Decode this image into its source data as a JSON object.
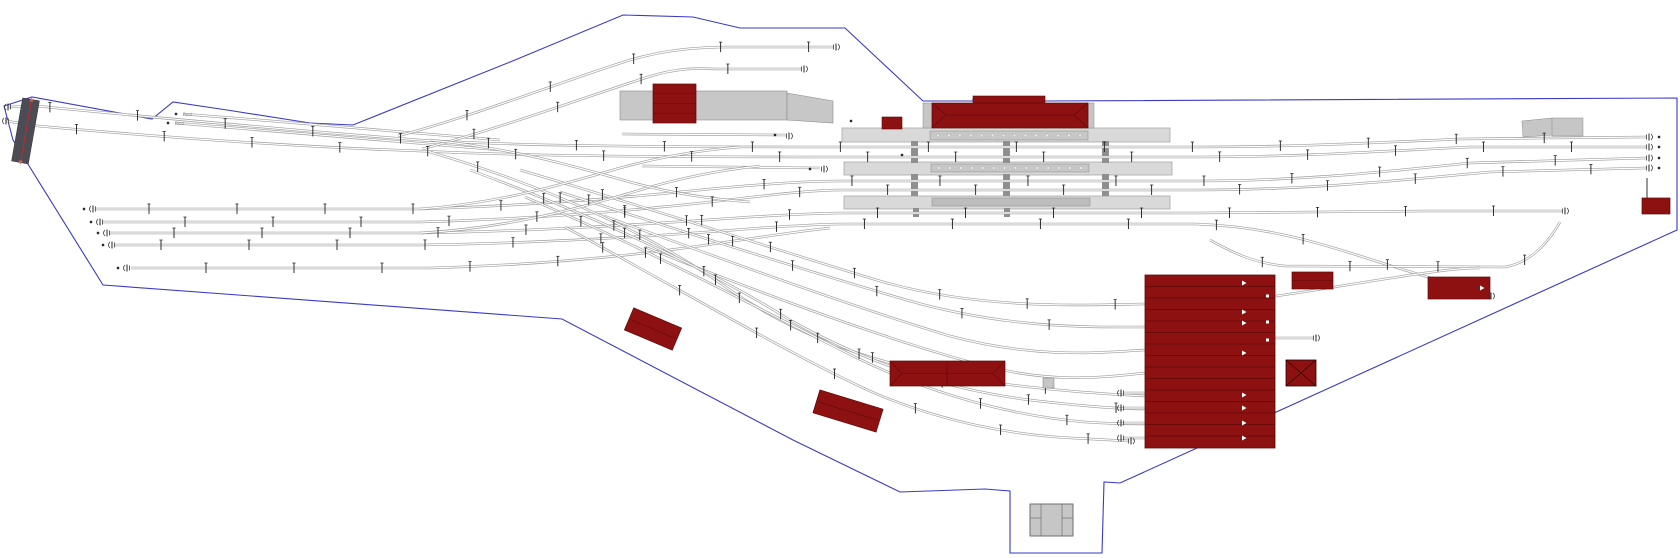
{
  "canvas": {
    "w": 1680,
    "h": 558,
    "bg": "#ffffff"
  },
  "palette": {
    "boundary": "#3a3ac8",
    "rail": "#9d9d9d",
    "rail_core": "#ffffff",
    "mast": "#1c1c1c",
    "red": "#8e1111",
    "red_dark": "#5c0a0a",
    "platform": "#d9d9d9",
    "platform_border": "#a8a8a8",
    "canopy": "#c7c7c7",
    "canopy_dot": "#f4f4f4",
    "inner_strip": "#bdbdbd",
    "connector": "#8f8f8f",
    "bridge": "#4c4c55",
    "bridge_line": "#b03030",
    "gray_bldg": "#c6c6c6",
    "gray_border": "#8a8a8a",
    "buffer": "#3a3a3a",
    "dot": "#2a2a2a"
  },
  "boundary": {
    "points": [
      [
        4,
        106
      ],
      [
        32,
        97
      ],
      [
        152,
        119
      ],
      [
        173,
        102
      ],
      [
        227,
        110
      ],
      [
        310,
        123
      ],
      [
        353,
        125
      ],
      [
        515,
        60
      ],
      [
        623,
        15
      ],
      [
        693,
        17
      ],
      [
        740,
        28
      ],
      [
        845,
        28
      ],
      [
        923,
        101
      ],
      [
        973,
        101
      ],
      [
        973,
        99
      ],
      [
        1043,
        99
      ],
      [
        1043,
        101
      ],
      [
        1677,
        98
      ],
      [
        1677,
        230
      ],
      [
        1120,
        483
      ],
      [
        1104,
        482
      ],
      [
        1102,
        553
      ],
      [
        1010,
        553
      ],
      [
        1010,
        491
      ],
      [
        985,
        489
      ],
      [
        900,
        492
      ],
      [
        793,
        440
      ],
      [
        562,
        319
      ],
      [
        103,
        285
      ],
      [
        13,
        140
      ]
    ]
  },
  "tracks": [
    {
      "name": "main-line-1",
      "masts": true,
      "d": "M 8 107 L 36 106 C 160 118 300 131 420 140 C 520 146 650 147 840 147 L 1195 147 C 1300 147 1390 142 1460 139 L 1646 137"
    },
    {
      "name": "main-line-2",
      "masts": true,
      "d": "M 6 121 L 38 126 C 160 137 300 147 420 151 C 530 156 650 157 840 157 L 1195 157 C 1310 157 1400 150 1470 147 L 1646 147"
    },
    {
      "name": "siding-rest-a",
      "masts": false,
      "d": "M 183 114 C 290 122 400 132 500 140"
    },
    {
      "name": "siding-rest-b",
      "masts": false,
      "d": "M 175 123 C 290 132 400 142 500 150"
    },
    {
      "name": "yard-track-1",
      "masts": true,
      "d": "M 96 209 L 420 209 C 520 206 610 199 690 191 C 750 185 800 181 840 181 L 1195 181 C 1310 181 1400 170 1470 163 L 1646 158"
    },
    {
      "name": "yard-track-2",
      "masts": true,
      "d": "M 103 222 L 420 222 C 530 219 630 211 710 202 C 770 195 810 190 845 190 L 1195 190 C 1320 190 1420 178 1490 172 L 1646 168"
    },
    {
      "name": "yard-track-3",
      "masts": true,
      "d": "M 110 233 L 420 233 C 540 231 650 224 750 217 C 800 214 825 213 845 213 L 1195 213 C 1280 213 1360 212 1430 211 L 1562 211"
    },
    {
      "name": "yard-track-4",
      "masts": true,
      "d": "M 115 245 L 420 245 C 550 243 660 236 760 228 C 805 225 825 224 845 224 L 1195 224 C 1260 226 1310 240 1360 256 C 1410 272 1450 284 1488 295"
    },
    {
      "name": "yard-track-5",
      "masts": true,
      "d": "M 131 268 L 430 268 C 540 265 640 255 720 243 C 770 236 800 231 830 228"
    },
    {
      "name": "right-loop",
      "masts": true,
      "d": "M 1210 240 C 1235 254 1255 263 1285 266 L 1505 267 C 1530 263 1548 243 1560 222"
    },
    {
      "name": "right-cross",
      "masts": false,
      "d": "M 1232 302 C 1300 294 1370 280 1440 271 C 1455 269 1468 268 1480 268"
    },
    {
      "name": "depot-feed-1",
      "masts": true,
      "d": "M 520 170 C 650 208 770 248 880 281 C 980 310 1080 305 1145 304"
    },
    {
      "name": "depot-feed-2",
      "masts": true,
      "d": "M 560 192 C 690 234 810 272 910 301 C 1010 329 1090 327 1145 327"
    },
    {
      "name": "depot-feed-3",
      "masts": false,
      "d": "M 604 216 C 730 262 850 306 950 336 C 1040 360 1105 352 1145 350"
    },
    {
      "name": "depot-feed-4",
      "masts": false,
      "d": "M 645 247 C 770 297 890 341 985 366 C 1060 385 1112 376 1145 373"
    },
    {
      "name": "south-curve-1",
      "masts": true,
      "d": "M 430 152 C 560 190 660 240 730 290 C 800 338 880 365 960 378 C 1040 390 1100 394 1145 396"
    },
    {
      "name": "south-curve-2",
      "masts": true,
      "d": "M 470 170 C 600 218 710 270 790 320 C 870 365 950 390 1030 400 C 1090 407 1125 409 1145 409"
    },
    {
      "name": "south-curve-3",
      "masts": true,
      "d": "M 525 197 C 655 252 765 312 855 357 C 935 396 1015 416 1085 422 C 1115 424 1135 424 1145 424"
    },
    {
      "name": "south-curve-4",
      "masts": true,
      "d": "M 565 227 C 685 292 785 352 872 392 C 942 422 1012 435 1072 438 L 1128 441"
    },
    {
      "name": "north-branch-1",
      "masts": true,
      "d": "M 398 136 C 480 114 560 82 630 60 C 668 49 700 47 732 47 L 833 47"
    },
    {
      "name": "north-branch-2",
      "masts": true,
      "d": "M 422 149 C 505 127 585 97 648 77 C 682 66 702 69 724 69 L 801 69"
    },
    {
      "name": "mid-stub-1",
      "masts": false,
      "d": "M 622 134 L 786 135"
    },
    {
      "name": "mid-stub-2",
      "masts": false,
      "d": "M 642 166 L 820 168"
    },
    {
      "name": "ladder-diag-1",
      "masts": false,
      "d": "M 420 209 C 500 203 560 185 620 168 C 660 157 700 150 740 147"
    },
    {
      "name": "ladder-diag-2",
      "masts": false,
      "d": "M 420 233 C 510 228 580 208 640 190 C 680 178 720 170 760 166"
    },
    {
      "name": "ladder-diag-3",
      "masts": false,
      "d": "M 430 140 C 510 148 570 165 630 182 C 670 193 710 199 750 202"
    },
    {
      "name": "depot-stub-a",
      "masts": false,
      "d": "M 1124 393 L 1145 393"
    },
    {
      "name": "depot-stub-b",
      "masts": false,
      "d": "M 1124 408 L 1145 408"
    },
    {
      "name": "depot-stub-c",
      "masts": false,
      "d": "M 1124 423 L 1145 423"
    },
    {
      "name": "depot-stub-d",
      "masts": false,
      "d": "M 1124 438 L 1145 438"
    },
    {
      "name": "depot-right-stub",
      "masts": false,
      "d": "M 1275 338 L 1313 338"
    }
  ],
  "mast_cfg": {
    "spacing": 88,
    "start": 42,
    "len": 10
  },
  "buffers": [
    {
      "x": 93,
      "y": 209,
      "dir": -1
    },
    {
      "x": 100,
      "y": 222,
      "dir": -1
    },
    {
      "x": 107,
      "y": 233,
      "dir": -1
    },
    {
      "x": 112,
      "y": 245,
      "dir": -1
    },
    {
      "x": 127,
      "y": 268,
      "dir": -1
    },
    {
      "x": 8,
      "y": 107,
      "dir": -1
    },
    {
      "x": 6,
      "y": 121,
      "dir": -1
    },
    {
      "x": 1121,
      "y": 393,
      "dir": -1
    },
    {
      "x": 1121,
      "y": 408,
      "dir": -1
    },
    {
      "x": 1121,
      "y": 423,
      "dir": -1
    },
    {
      "x": 1121,
      "y": 438,
      "dir": -1
    },
    {
      "x": 836,
      "y": 47,
      "dir": 1
    },
    {
      "x": 804,
      "y": 69,
      "dir": 1
    },
    {
      "x": 789,
      "y": 136,
      "dir": 1
    },
    {
      "x": 824,
      "y": 169,
      "dir": 1
    },
    {
      "x": 1649,
      "y": 137,
      "dir": 1
    },
    {
      "x": 1649,
      "y": 147,
      "dir": 1
    },
    {
      "x": 1649,
      "y": 158,
      "dir": 1
    },
    {
      "x": 1649,
      "y": 168,
      "dir": 1
    },
    {
      "x": 1565,
      "y": 211,
      "dir": 1
    },
    {
      "x": 1491,
      "y": 296,
      "dir": 1
    },
    {
      "x": 1316,
      "y": 338,
      "dir": 1
    },
    {
      "x": 1131,
      "y": 441,
      "dir": 1
    }
  ],
  "dots": [
    [
      84,
      209
    ],
    [
      91,
      222
    ],
    [
      98,
      233
    ],
    [
      103,
      245
    ],
    [
      118,
      268
    ],
    [
      1659,
      137
    ],
    [
      1659,
      147
    ],
    [
      1659,
      158
    ],
    [
      1659,
      168
    ],
    [
      176,
      114
    ],
    [
      168,
      123
    ],
    [
      775,
      135
    ],
    [
      810,
      169
    ],
    [
      851,
      121
    ],
    [
      902,
      155
    ]
  ],
  "platforms": [
    {
      "name": "platform-1",
      "x": 842,
      "y": 128,
      "w": 328,
      "h": 14
    },
    {
      "name": "platform-2",
      "x": 844,
      "y": 162,
      "w": 328,
      "h": 13
    },
    {
      "name": "platform-3",
      "x": 844,
      "y": 196,
      "w": 326,
      "h": 13
    }
  ],
  "canopies": [
    {
      "name": "canopy-1",
      "x": 930,
      "y": 131,
      "w": 158,
      "h": 9,
      "dots": 14
    },
    {
      "name": "canopy-2",
      "x": 931,
      "y": 164,
      "w": 158,
      "h": 8,
      "dots": 14
    },
    {
      "name": "canopy-3",
      "x": 932,
      "y": 198,
      "w": 158,
      "h": 8,
      "dots": 0
    }
  ],
  "connectors": [
    [
      911,
      141,
      7,
      22
    ],
    [
      911,
      174,
      7,
      22
    ],
    [
      913,
      208,
      6,
      9
    ],
    [
      1003,
      115,
      7,
      13
    ],
    [
      1003,
      141,
      7,
      22
    ],
    [
      1003,
      174,
      7,
      22
    ],
    [
      1004,
      208,
      6,
      9
    ],
    [
      1102,
      141,
      7,
      22
    ],
    [
      1102,
      174,
      7,
      22
    ]
  ],
  "loading_dock": {
    "rect": {
      "x": 620,
      "y": 91,
      "w": 167,
      "h": 29
    },
    "wedge": [
      [
        787,
        93
      ],
      [
        833,
        101
      ],
      [
        833,
        123
      ],
      [
        787,
        120
      ]
    ]
  },
  "station": {
    "building": {
      "x": 932,
      "y": 103,
      "w": 156,
      "h": 25
    },
    "center_raised": {
      "x": 973,
      "y": 96,
      "w": 72,
      "h": 7
    },
    "cap_left": {
      "x": 923,
      "y": 103,
      "w": 9,
      "h": 25
    },
    "cap_right": {
      "x": 1088,
      "y": 103,
      "w": 6,
      "h": 25
    },
    "annex": {
      "x": 882,
      "y": 117,
      "w": 20,
      "h": 12
    }
  },
  "goods_shed": {
    "x": 653,
    "y": 84,
    "w": 43,
    "h": 39,
    "lines": 3
  },
  "depot": {
    "x": 1145,
    "y": 275,
    "w": 130,
    "h": 173,
    "stall_step": 11.5,
    "arrow_x": 1242,
    "arrows_y": [
      283,
      312,
      323,
      353,
      395,
      408,
      423,
      438
    ],
    "square_x": 1266,
    "squares_y": [
      296,
      322,
      340
    ]
  },
  "red_shed_1": {
    "x": 1292,
    "y": 272,
    "w": 41,
    "h": 17
  },
  "red_shed_2": {
    "x": 1428,
    "y": 277,
    "w": 62,
    "h": 22,
    "arrow": [
      1480,
      288
    ]
  },
  "x_square": {
    "x": 1286,
    "y": 360,
    "w": 30,
    "h": 26
  },
  "far_right_shed": {
    "x": 1642,
    "y": 198,
    "w": 28,
    "h": 16,
    "pole": [
      1647,
      178,
      1647,
      198
    ]
  },
  "tilted_sheds": [
    {
      "name": "tilted-shed-1",
      "x": 627,
      "y": 317,
      "w": 52,
      "h": 24,
      "rot": 23
    },
    {
      "name": "tilted-shed-2",
      "x": 815,
      "y": 399,
      "w": 66,
      "h": 24,
      "rot": 17
    }
  ],
  "long_hip_shed": {
    "x": 890,
    "y": 361,
    "w": 115,
    "h": 25,
    "divider_x": 947
  },
  "gray_square": {
    "x": 1043,
    "y": 378,
    "w": 11,
    "h": 10
  },
  "bottom_gray_building": {
    "x": 1030,
    "y": 504,
    "w": 43,
    "h": 32,
    "v1": 1041,
    "v2": 1062,
    "hline": 518
  },
  "ramps": {
    "wedge": [
      [
        1522,
        121
      ],
      [
        1552,
        118
      ],
      [
        1553,
        135
      ],
      [
        1523,
        137
      ]
    ],
    "rect": {
      "x": 1552,
      "y": 118,
      "w": 31,
      "h": 18
    }
  },
  "bridge": {
    "x": 17,
    "y": 99,
    "w": 17,
    "h": 64,
    "rot": 10,
    "cx": 26,
    "cy": 131
  },
  "labels": [
    {
      "x": 183,
      "y": 116,
      "text": "Rest"
    },
    {
      "x": 175,
      "y": 125,
      "text": "Rest"
    }
  ]
}
